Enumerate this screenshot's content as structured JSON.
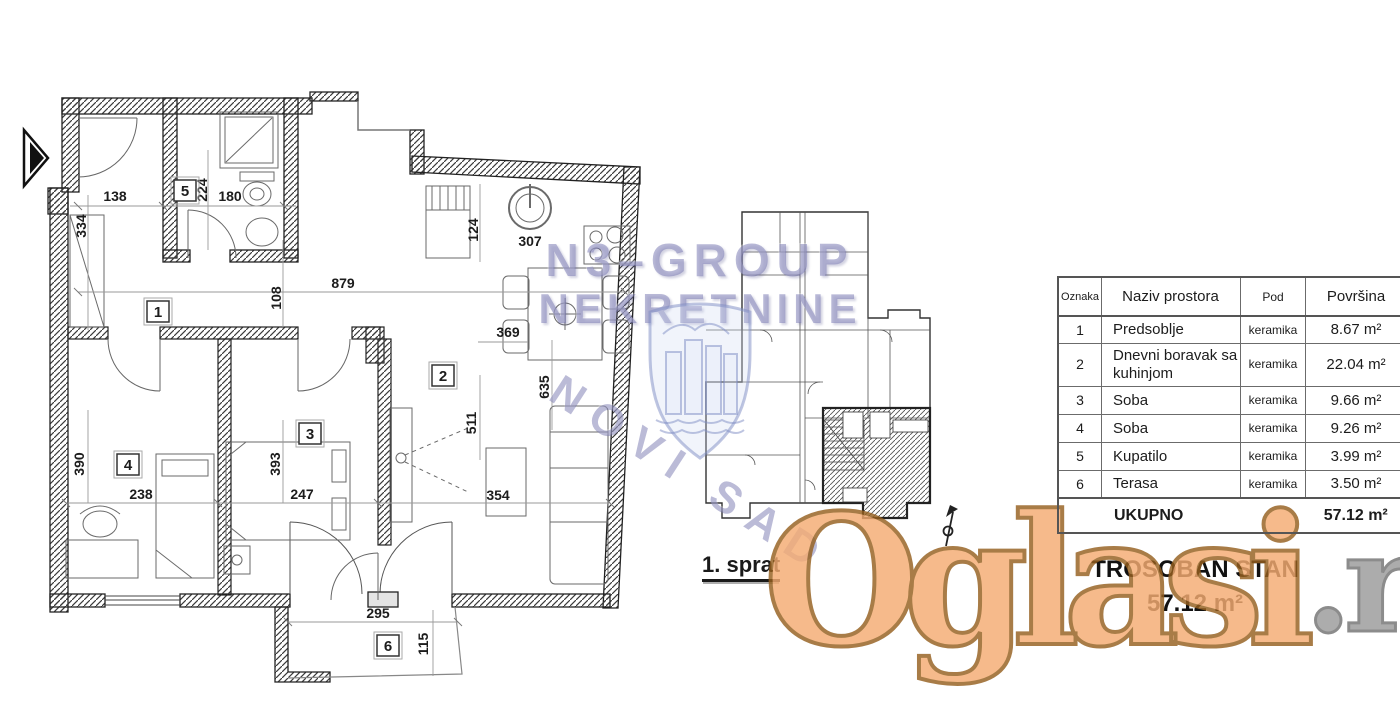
{
  "captions": {
    "floor_label": "1. sprat",
    "apt_type": "TROSOBAN STAN",
    "apt_area": "57.12 m²"
  },
  "watermarks": {
    "brand_line1": "N3–GROUP",
    "brand_line2": "NEKRETNINE",
    "city": "NOVI SAD",
    "portal": "Oglasi",
    "portal_tld": ".rs",
    "brand_color": "#8080b6",
    "portal_color": "#f5ac72",
    "portal_outline": "#96601f"
  },
  "table": {
    "headers": [
      "Oznaka",
      "Naziv prostora",
      "Pod",
      "Površina"
    ],
    "rows": [
      {
        "oznaka": "1",
        "naziv": "Predsoblje",
        "pod": "keramika",
        "povrsina": "8.67 m²"
      },
      {
        "oznaka": "2",
        "naziv": "Dnevni boravak sa kuhinjom",
        "pod": "keramika",
        "povrsina": "22.04 m²"
      },
      {
        "oznaka": "3",
        "naziv": "Soba",
        "pod": "keramika",
        "povrsina": "9.66 m²"
      },
      {
        "oznaka": "4",
        "naziv": "Soba",
        "pod": "keramika",
        "povrsina": "9.26 m²"
      },
      {
        "oznaka": "5",
        "naziv": "Kupatilo",
        "pod": "keramika",
        "povrsina": "3.99 m²"
      },
      {
        "oznaka": "6",
        "naziv": "Terasa",
        "pod": "keramika",
        "povrsina": "3.50 m²"
      }
    ],
    "total": {
      "label": "UKUPNO",
      "value": "57.12 m²"
    }
  },
  "rooms": {
    "r1": "1",
    "r2": "2",
    "r3": "3",
    "r4": "4",
    "r5": "5",
    "r6": "6"
  },
  "dims": {
    "d138": "138",
    "d334": "334",
    "d224": "224",
    "d180": "180",
    "d108": "108",
    "d879": "879",
    "d124": "124",
    "d307": "307",
    "d369": "369",
    "d511": "511",
    "d635": "635",
    "d354": "354",
    "d393": "393",
    "d247": "247",
    "d390": "390",
    "d238": "238",
    "d295": "295",
    "d115": "115"
  }
}
